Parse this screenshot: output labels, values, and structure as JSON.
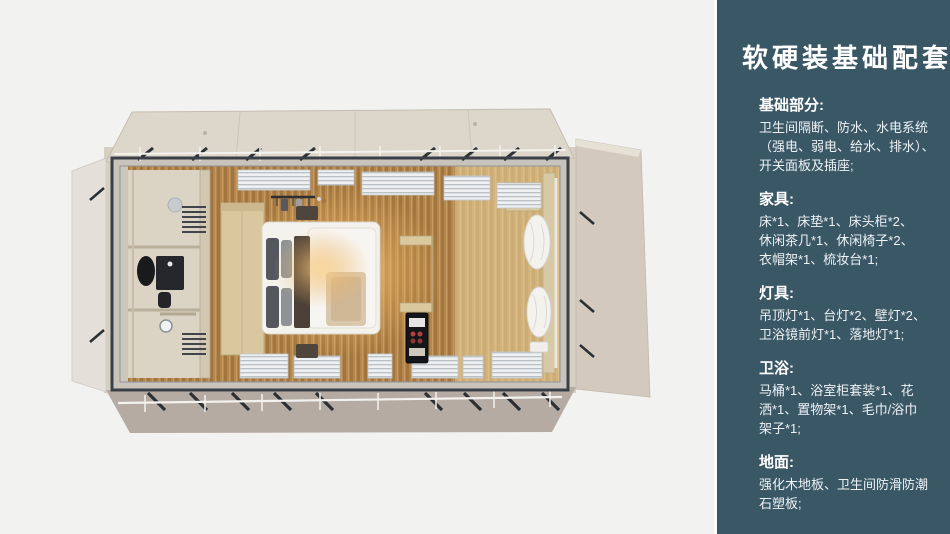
{
  "panel": {
    "title": "软硬装基础配套",
    "sections": [
      {
        "heading": "基础部分:",
        "lines": [
          "卫生间隔断、防水、水电系统",
          "（强电、弱电、给水、排水）、",
          "开关面板及插座;"
        ]
      },
      {
        "heading": "家具:",
        "lines": [
          "床*1、床垫*1、床头柜*2、",
          "休闲茶几*1、休闲椅子*2、",
          "衣帽架*1、梳妆台*1;"
        ]
      },
      {
        "heading": "灯具:",
        "lines": [
          "吊顶灯*1、台灯*2、壁灯*2、",
          "卫浴镜前灯*1、落地灯*1;"
        ]
      },
      {
        "heading": "卫浴:",
        "lines": [
          "马桶*1、浴室柜套装*1、花",
          "洒*1、置物架*1、毛巾/浴巾",
          "架子*1;"
        ]
      },
      {
        "heading": "地面:",
        "lines": [
          "强化木地板、卫生间防滑防潮",
          "石塑板;"
        ]
      }
    ]
  },
  "floorplan": {
    "alt_text": "卧室与卫生间俯视渲染图"
  },
  "colors": {
    "page_background": "#f2f2f1",
    "panel_background": "#3a5766",
    "panel_text": "#ffffff",
    "cabin_wall_beige": "#d7cfc2",
    "cabin_shadow_taupe": "#b5aba3",
    "metal_frame": "#3a4048",
    "wood_floor": "#b3874d",
    "lamp_glow": "#f6c77c",
    "bed_white": "#f4f2ed"
  }
}
